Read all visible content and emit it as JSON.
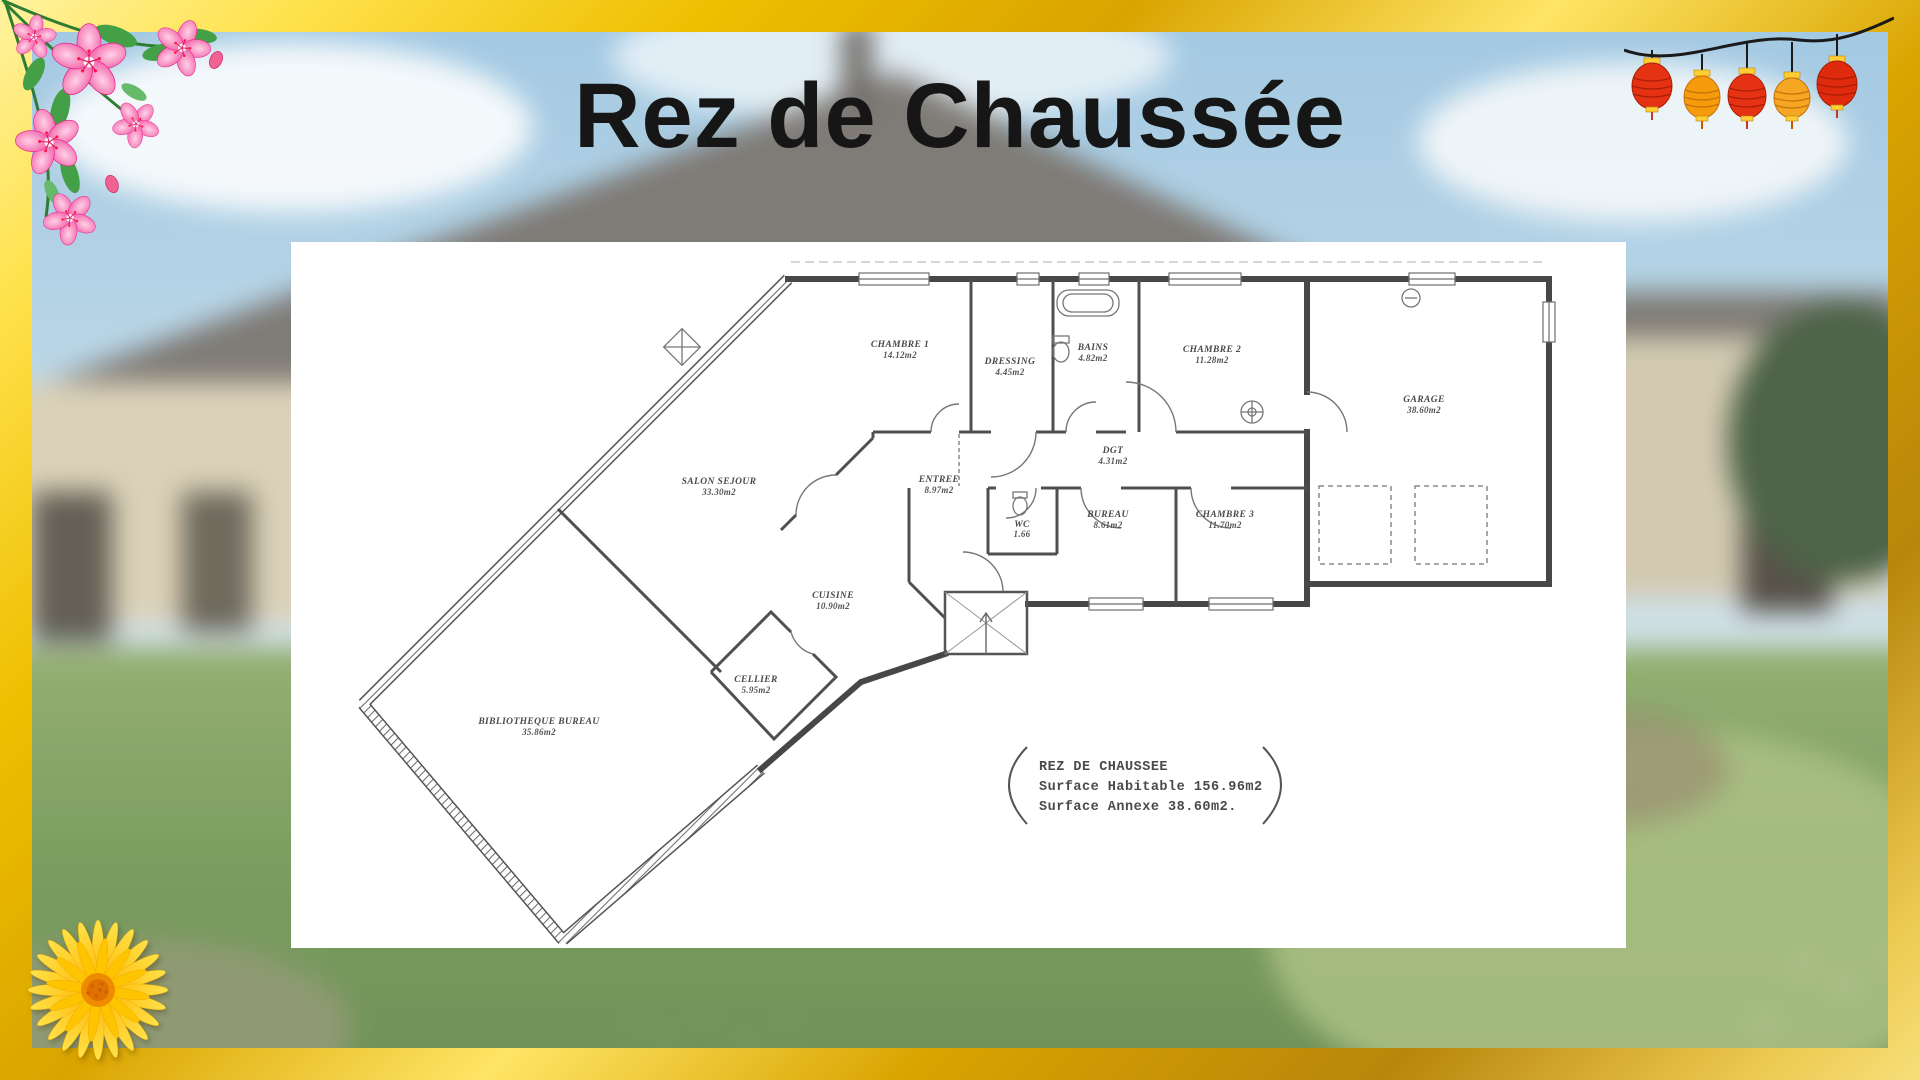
{
  "title": "Rez de Chaussée",
  "floorplan": {
    "rooms": [
      {
        "label": "CHAMBRE 1",
        "area": "14.12m2"
      },
      {
        "label": "DRESSING",
        "area": "4.45m2"
      },
      {
        "label": "BAINS",
        "area": "4.82m2"
      },
      {
        "label": "CHAMBRE 2",
        "area": "11.28m2"
      },
      {
        "label": "GARAGE",
        "area": "38.60m2"
      },
      {
        "label": "SALON SEJOUR",
        "area": "33.30m2"
      },
      {
        "label": "ENTREE",
        "area": "8.97m2"
      },
      {
        "label": "DGT",
        "area": "4.31m2"
      },
      {
        "label": "WC",
        "area": "1.66"
      },
      {
        "label": "BUREAU",
        "area": "8.61m2"
      },
      {
        "label": "CHAMBRE 3",
        "area": "11.70m2"
      },
      {
        "label": "CUISINE",
        "area": "10.90m2"
      },
      {
        "label": "CELLIER",
        "area": "5.95m2"
      },
      {
        "label": "BIBLIOTHEQUE BUREAU",
        "area": "35.86m2"
      }
    ],
    "summary": {
      "title": "REZ DE CHAUSSEE",
      "habitable": "Surface Habitable 156.96m2",
      "annexe": "Surface Annexe 38.60m2."
    }
  },
  "decorations": {
    "top_left": "pink-flowers-ornament",
    "top_right": "paper-lanterns-garland",
    "bottom_left": "yellow-daisy-flower",
    "colors": {
      "frame_gold": "#e0a800",
      "lantern_red": "#e53212",
      "lantern_orange": "#f59b0c",
      "flower_pink": "#f0549f",
      "daisy_yellow": "#ffc107",
      "plan_wall": "#474747"
    }
  }
}
